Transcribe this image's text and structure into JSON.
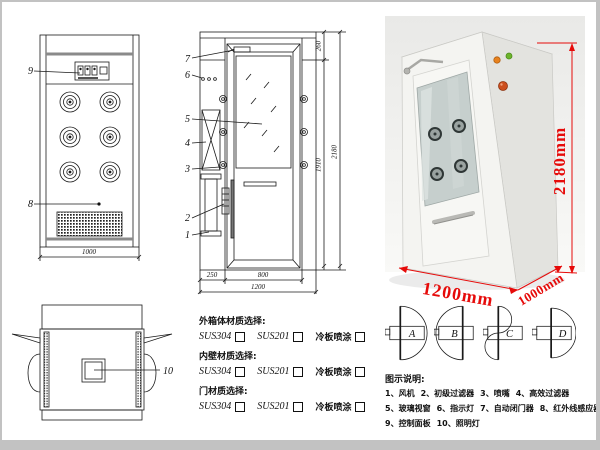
{
  "drawing": {
    "front_view": {
      "label_9": "9",
      "label_8": "8",
      "dim_width": "1000"
    },
    "side_view": {
      "labels": [
        "7",
        "6",
        "5",
        "4",
        "3",
        "2",
        "1"
      ],
      "dim_260": "260",
      "dim_1910": "1910",
      "dim_2180": "2180",
      "dim_250": "250",
      "dim_800": "800",
      "dim_1200": "1200"
    },
    "top_view": {
      "label_10": "10"
    }
  },
  "photo": {
    "dim_height": "2180mm",
    "dim_width": "1200mm",
    "dim_depth": "1000mm"
  },
  "door_configs": {
    "a": "A",
    "b": "B",
    "c": "C",
    "d": "D"
  },
  "materials": {
    "groups": [
      {
        "title": "外箱体材质选择:",
        "opt1": "SUS304",
        "opt2": "SUS201",
        "opt3": "冷板喷涂"
      },
      {
        "title": "内壁材质选择:",
        "opt1": "SUS304",
        "opt2": "SUS201",
        "opt3": "冷板喷涂"
      },
      {
        "title": "门材质选择:",
        "opt1": "SUS304",
        "opt2": "SUS201",
        "opt3": "冷板喷涂"
      }
    ]
  },
  "legend": {
    "title": "图示说明:",
    "row1": [
      "1、风机",
      "2、初级过滤器",
      "3、喷嘴",
      "4、高效过滤器"
    ],
    "row2": [
      "5、玻璃视窗",
      "6、指示灯",
      "7、自动闭门器",
      "8、红外线感应器"
    ],
    "row3": [
      "9、控制面板",
      "10、照明灯"
    ]
  },
  "colors": {
    "dimension_red": "#e60b0a",
    "drawing_line": "#1a1a1a",
    "indicator_orange": "#e8821e",
    "indicator_green": "#6db52c",
    "knob_red": "#cc4f1e",
    "glass_tint": "#c6cfcd"
  }
}
